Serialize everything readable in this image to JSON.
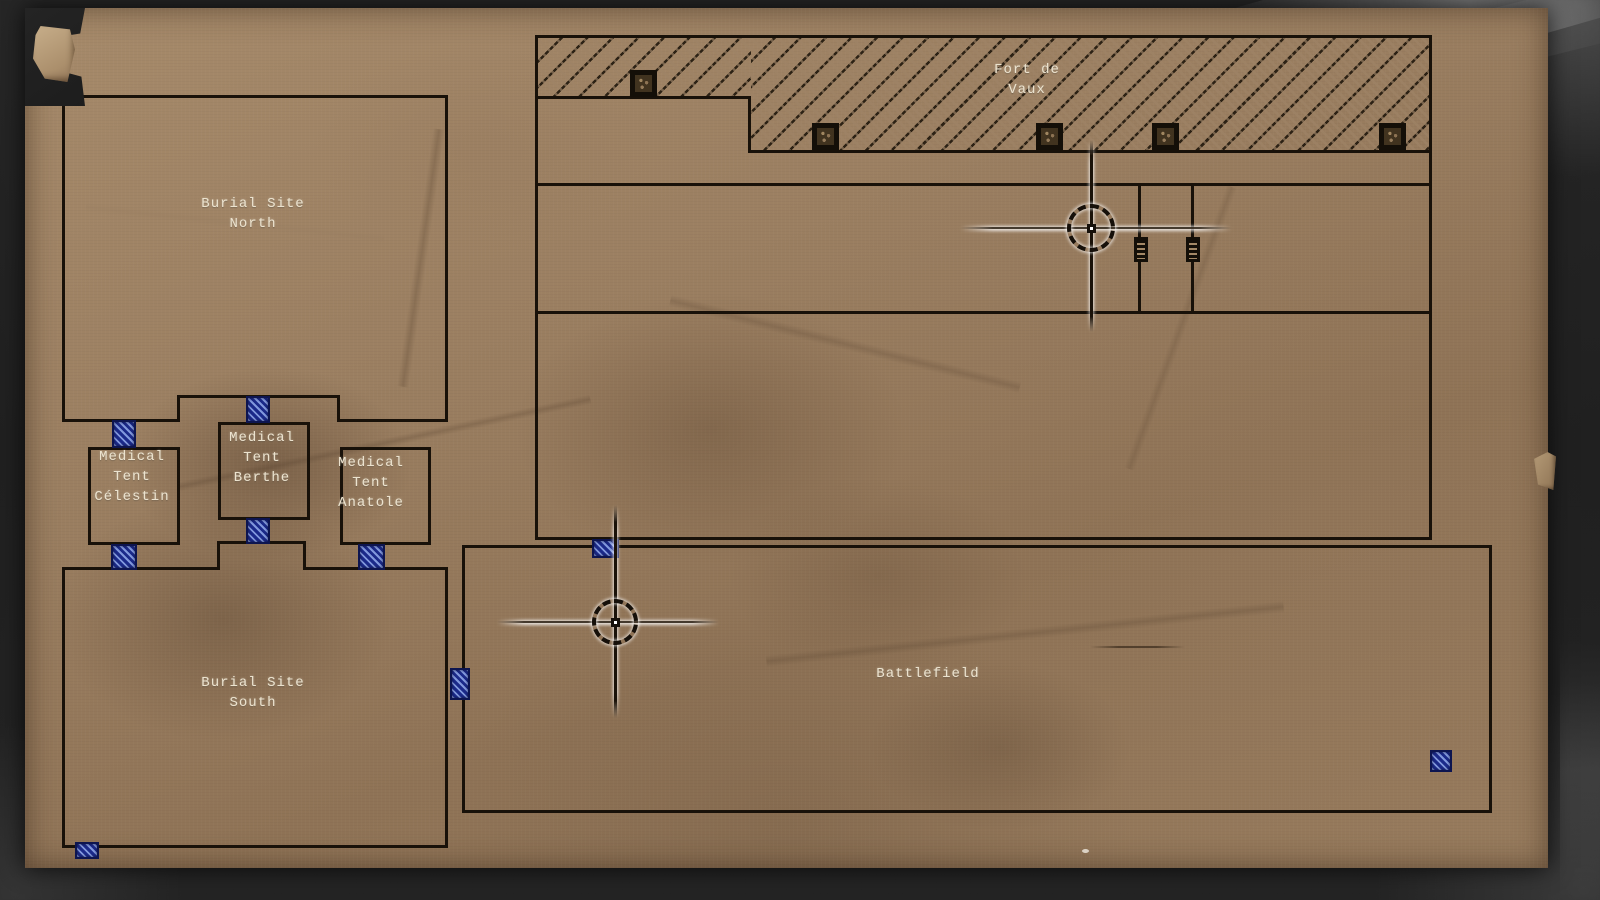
{
  "screen": {
    "name": "tactical field map",
    "style": "aged paper battlefield map"
  },
  "regions": [
    {
      "id": "burial-site-north",
      "label": "Burial Site\nNorth"
    },
    {
      "id": "medical-tent-celestin",
      "label": "Medical\nTent\nCélestin"
    },
    {
      "id": "medical-tent-berthe",
      "label": "Medical\nTent\nBerthe"
    },
    {
      "id": "medical-tent-anatole",
      "label": "Medical\nTent\nAnatole"
    },
    {
      "id": "burial-site-south",
      "label": "Burial Site\nSouth"
    },
    {
      "id": "fort-de-vaux",
      "label": "Fort de\nVaux"
    },
    {
      "id": "battlefield",
      "label": "Battlefield"
    }
  ],
  "markers": {
    "door_markers": [
      {
        "x": 112,
        "y": 420,
        "w": 24,
        "h": 28
      },
      {
        "x": 246,
        "y": 396,
        "w": 24,
        "h": 27
      },
      {
        "x": 246,
        "y": 518,
        "w": 24,
        "h": 26
      },
      {
        "x": 111,
        "y": 544,
        "w": 26,
        "h": 26
      },
      {
        "x": 358,
        "y": 544,
        "w": 27,
        "h": 26
      },
      {
        "x": 592,
        "y": 539,
        "w": 27,
        "h": 19
      },
      {
        "x": 450,
        "y": 668,
        "w": 20,
        "h": 32
      },
      {
        "x": 1430,
        "y": 750,
        "w": 22,
        "h": 22
      },
      {
        "x": 75,
        "y": 842,
        "w": 24,
        "h": 17
      }
    ],
    "hatch_door_icons": [
      {
        "x": 630,
        "y": 70
      },
      {
        "x": 812,
        "y": 123
      },
      {
        "x": 1036,
        "y": 123
      },
      {
        "x": 1152,
        "y": 123
      },
      {
        "x": 1379,
        "y": 123
      }
    ],
    "ladder_icons": [
      {
        "x": 1134,
        "y": 237
      },
      {
        "x": 1186,
        "y": 237
      }
    ],
    "crosshair_markers": [
      {
        "x": 1091,
        "y": 228,
        "top": 140,
        "bottom": 332,
        "left": 960,
        "right": 1232,
        "radius": 24
      },
      {
        "x": 615,
        "y": 622,
        "top": 505,
        "bottom": 718,
        "left": 497,
        "right": 719,
        "radius": 23
      }
    ]
  },
  "icons": {
    "door_marker": "door-marker",
    "fort_hatch_door": "hatch-door-icon",
    "ladder": "ladder-icon",
    "crosshair": "crosshair-marker-icon"
  },
  "colors": {
    "paper": "#9b7f61",
    "ink": "#181109",
    "door_blue": "#1b2a8a",
    "label_text": "#ece3cf",
    "frame_background": "#232323"
  }
}
